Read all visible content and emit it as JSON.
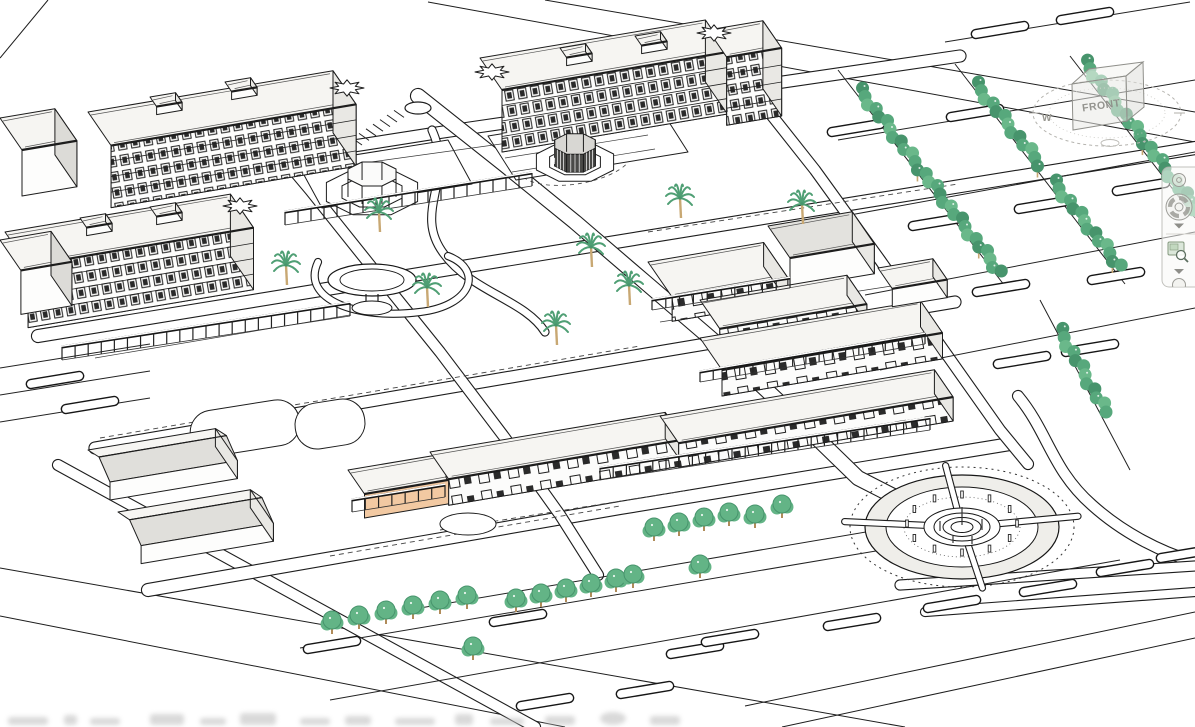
{
  "viewcube": {
    "front_face_label": "FRONT",
    "compass_west_label": "W"
  },
  "navigation_bar": {
    "tools": [
      {
        "name": "steering-wheel-mini-button",
        "icon": "navigation-wheel-mini-icon"
      },
      {
        "name": "full-navigation-wheel-button",
        "icon": "steering-wheel-icon"
      },
      {
        "name": "wheel-options-dropdown",
        "icon": "chevron-down-icon"
      },
      {
        "name": "zoom-region-button",
        "icon": "zoom-region-icon"
      },
      {
        "name": "zoom-options-dropdown",
        "icon": "chevron-down-icon"
      },
      {
        "name": "next-tool-button",
        "icon": "circle-tool-icon"
      }
    ]
  },
  "palette": {
    "line_black": "#1d1d1d",
    "line_soft": "#444444",
    "roof_light": "#f6f5f2",
    "roof_gray": "#e3e2de",
    "wall_shade": "#e9e8e4",
    "ring_gray": "#efeeea",
    "tree_green": "#57a87c",
    "tree_green_dark": "#47946c",
    "tree_green_light": "#6ab88a",
    "shrub_green": "#63b486",
    "palm_green": "#4f9f74",
    "palm_trunk": "#c8a873",
    "accent_orange": "#f2c9a2",
    "viewcube_gray": "#8f8f8a",
    "navbar_icon": "#9c9c97"
  }
}
